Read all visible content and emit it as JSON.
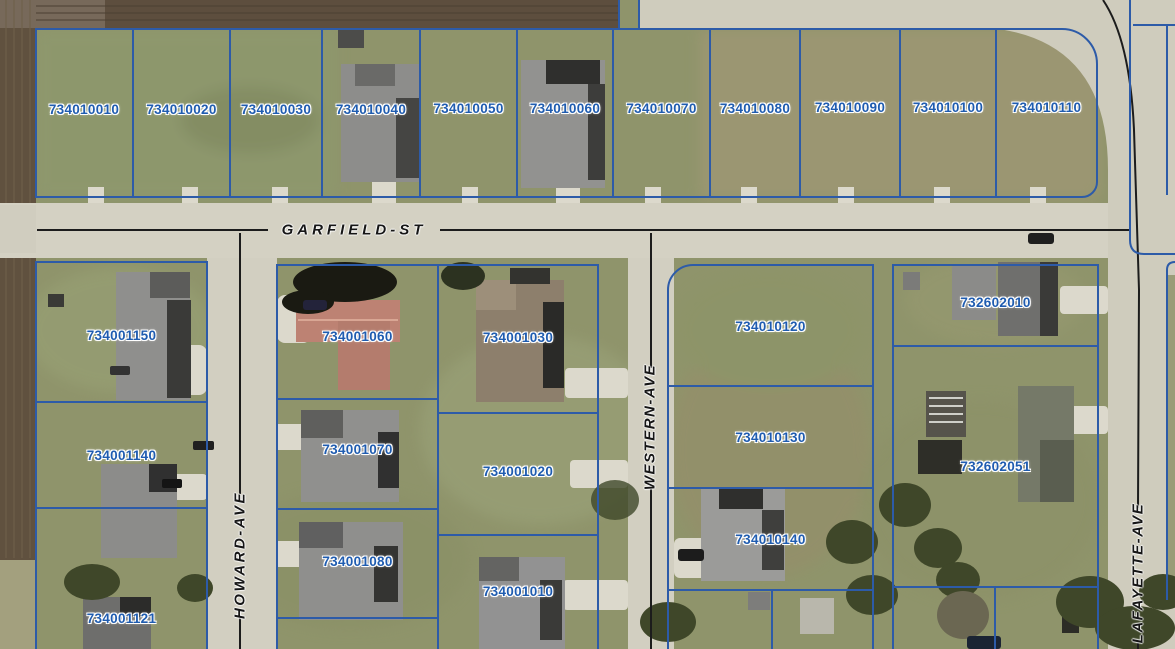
{
  "streets": {
    "garfield": "GARFIELD-ST",
    "howard": "HOWARD-AVE",
    "western": "WESTERN-AVE",
    "lafayette": "LAFAYETTE-AVE"
  },
  "parcels": [
    {
      "id": "734010010"
    },
    {
      "id": "734010020"
    },
    {
      "id": "734010030"
    },
    {
      "id": "734010040"
    },
    {
      "id": "734010050"
    },
    {
      "id": "734010060"
    },
    {
      "id": "734010070"
    },
    {
      "id": "734010080"
    },
    {
      "id": "734010090"
    },
    {
      "id": "734010100"
    },
    {
      "id": "734010110"
    },
    {
      "id": "734001150"
    },
    {
      "id": "734001140"
    },
    {
      "id": "734001121"
    },
    {
      "id": "734001060"
    },
    {
      "id": "734001070"
    },
    {
      "id": "734001080"
    },
    {
      "id": "734001030"
    },
    {
      "id": "734001020"
    },
    {
      "id": "734001010"
    },
    {
      "id": "734010120"
    },
    {
      "id": "734010130"
    },
    {
      "id": "734010140"
    },
    {
      "id": "732602010"
    },
    {
      "id": "732602051"
    }
  ],
  "colors": {
    "parcel_line": "#2d5ba8",
    "parcel_label_text": "#1f5cb0",
    "street_label_text": "#161616",
    "road_centerline": "#1c1c1c"
  }
}
